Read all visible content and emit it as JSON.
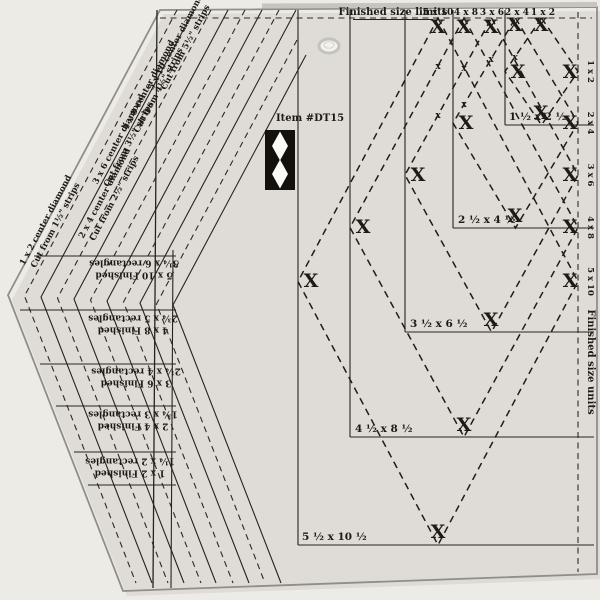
{
  "item_label": "Item #DT15",
  "header": {
    "finished_size_limits": "Finished size limits",
    "finished_size_units": "Finished size units"
  },
  "top_sizes": [
    "5 x 10",
    "4 x 8",
    "3 x 6",
    "2 x 4",
    "1 x 2"
  ],
  "right_sizes": [
    "1 x 2",
    "2 x 4",
    "3 x 6",
    "4 x 8",
    "5 x 10"
  ],
  "trim_rects": [
    "1 ½ x 2 ½",
    "2 ½ x 4 ½",
    "3 ½ x 6 ½",
    "4 ½ x 8 ½",
    "5 ½ x 10 ½"
  ],
  "strips": [
    {
      "line1": "1 x 2 center diamond",
      "line2": "Cut from 1½\" strips"
    },
    {
      "line1": "2 x 4 center diamond",
      "line2": "Cut from 2½\" strips"
    },
    {
      "line1": "3 x 6 center diamond",
      "line2": "Cut from 3½\" strips"
    },
    {
      "line1": "4 x 8 center diamond",
      "line2": "Cut from 4½\" strips"
    },
    {
      "line1": "5 x 10 center diamond",
      "line2": "Cut from 5½\" strips"
    }
  ],
  "finished_blocks": [
    {
      "line1": "5 x 10 Finished",
      "line2": "3¼ x 6 rectangles"
    },
    {
      "line1": "4 x 8 Finished",
      "line2": "2¾ x 5 rectangles"
    },
    {
      "line1": "3 x 6 Finished",
      "line2": "2¼ x 4 rectangles"
    },
    {
      "line1": "2 x 4 Finished",
      "line2": "1¾ x 3 rectangles"
    },
    {
      "line1": "1 x 2 Finished",
      "line2": "1¼ x 2 rectangles"
    }
  ],
  "marks": {
    "glyph": "X",
    "small_glyph": "x"
  },
  "colors": {
    "background": "#edebe5",
    "ruler": "#fbfaf6",
    "ink": "#26231e",
    "logo": "#14110d",
    "edge": "#8f8e87"
  }
}
